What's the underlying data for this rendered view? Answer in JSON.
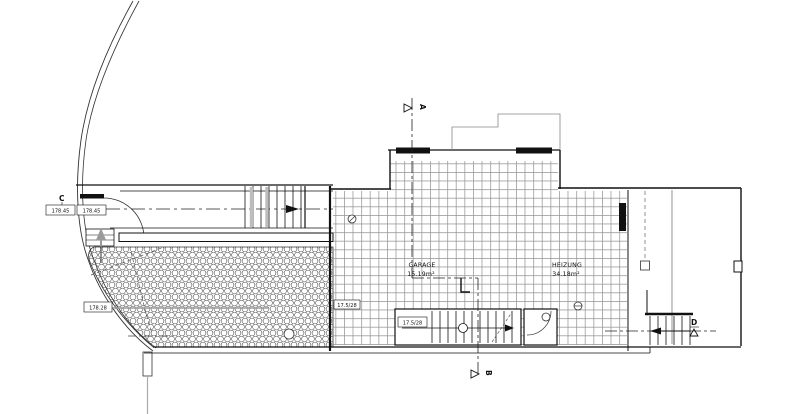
{
  "drawing": {
    "type": "architectural-floor-plan",
    "colors": {
      "background": "#ffffff",
      "line": "#1a1a1a",
      "hatch_grid": "#8f8f8f",
      "hatch_hex": "#4a4a4a",
      "gray": "#9a9a9a"
    },
    "rooms": {
      "garage": {
        "name": "GARAGE",
        "area": "15.19m²"
      },
      "heizung": {
        "name": "HEIZUNG",
        "area": "34.18m²"
      }
    },
    "section_markers": {
      "a": "A",
      "b": "B",
      "c": "C",
      "d": "D"
    },
    "tags": {
      "c_left": "178.45",
      "c_right": "178.45",
      "paving": "178.28",
      "wall": "17.5/28",
      "stair": "17.5/28"
    }
  }
}
